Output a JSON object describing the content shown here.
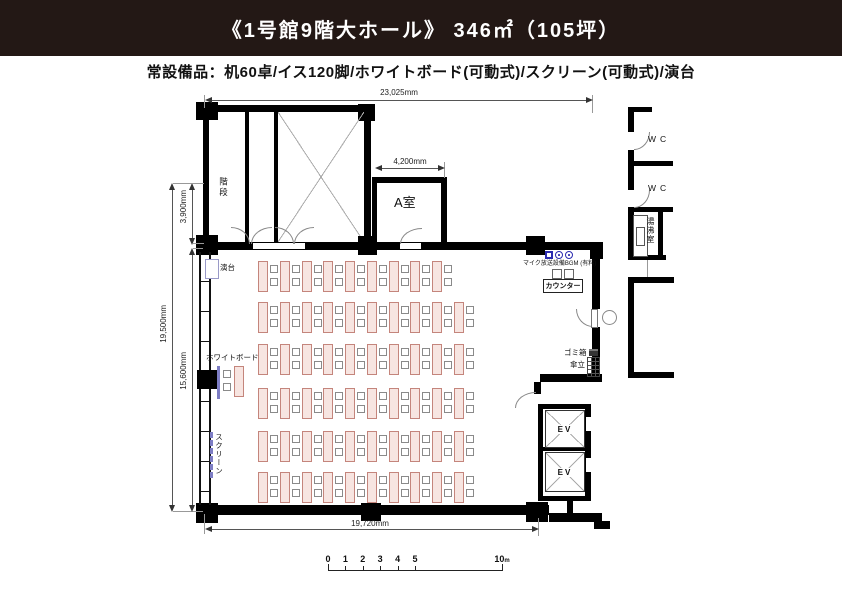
{
  "header": {
    "title": "《1号館9階大ホール》 346㎡（105坪）"
  },
  "subtitle": "常設備品：机60卓/イス120脚/ホワイトボード(可動式)/スクリーン(可動式)/演台",
  "rooms": {
    "stairs": "階段",
    "room_a": "A室",
    "wc_upper": "WC",
    "wc_lower": "WC",
    "kitchenette": "湯沸室",
    "ev_upper": "EV",
    "ev_lower": "EV"
  },
  "features": {
    "podium": "演台",
    "whiteboard": "ホワイトボード",
    "screen": "スクリーン",
    "mic_system": "マイク放送設備BGM (有料)",
    "counter": "カウンター",
    "trash_bin": "ゴミ箱",
    "umbrella_stand": "傘立"
  },
  "dimensions": {
    "overall_width": "23,025mm",
    "room_a_width": "4,200mm",
    "upper_depth": "3,900mm",
    "overall_depth": "19,500mm",
    "hall_depth": "15,600mm",
    "hall_width": "19,720mm"
  },
  "equipment_icons": [
    "mic-badge",
    "speaker-badge",
    "bgm-badge"
  ],
  "desks": {
    "rows_y": [
      261,
      302,
      344,
      388,
      431,
      472
    ],
    "cols_x": [
      258,
      280,
      302,
      323,
      345,
      367,
      389,
      410,
      432,
      454
    ],
    "row_counts": [
      9,
      10,
      10,
      10,
      10,
      10
    ],
    "desk_w": 8,
    "desk_h": 29,
    "chair": 6,
    "whiteboard_desk": {
      "x": 234,
      "y": 366
    }
  },
  "scale_bar": {
    "ticks": [
      {
        "label": "0",
        "m": 0
      },
      {
        "label": "1",
        "m": 1
      },
      {
        "label": "2",
        "m": 2
      },
      {
        "label": "3",
        "m": 3
      },
      {
        "label": "4",
        "m": 4
      },
      {
        "label": "5",
        "m": 5
      },
      {
        "label": "10",
        "m": 10
      }
    ],
    "unit": "m",
    "px_per_m": 17.4
  },
  "colors": {
    "header_bg": "#231815",
    "wall": "#000000",
    "desk_fill": "#f7e5e1",
    "desk_border": "#c4857c",
    "accent_blue": "#2b2bb0",
    "board_blue": "#7d7dc4"
  }
}
